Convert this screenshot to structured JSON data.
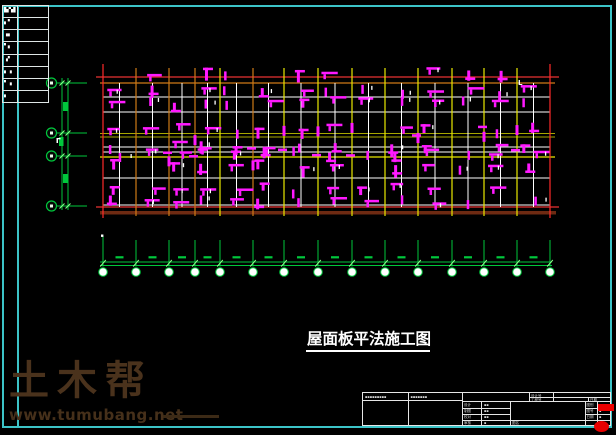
{
  "background": "#000000",
  "frame": {
    "color": "#3cc4c8",
    "table_rows": [
      "▙▚▌",
      "▖▘",
      "▗▖",
      "▘▖",
      "▗▘",
      "▖▗",
      "▘▗",
      "▖"
    ]
  },
  "drawing_title": {
    "text": "屋面板平法施工图"
  },
  "watermark": {
    "brand": "土木帮",
    "url": "www.tumubang.net",
    "color": "#4a321c"
  },
  "plan": {
    "beam_label": "L",
    "x_axes": [
      103,
      136,
      169,
      195,
      220,
      253,
      284,
      318,
      352,
      385,
      418,
      452,
      484,
      517,
      550
    ],
    "x_axis_colors": [
      "#ff2a2a",
      "#cf7a16",
      "#cf7a16",
      "#cf7a16",
      "#e8e800",
      "#cf7a16",
      "#e8e800",
      "#e8e800",
      "#e8e800",
      "#e8e800",
      "#e8e800",
      "#e8e800",
      "#e8e800",
      "#e8e800",
      "#ff2a2a"
    ],
    "h_lines": [
      {
        "y": 77,
        "x1": 96,
        "x2": 559,
        "c": "#e83232",
        "w": 1.2
      },
      {
        "y": 83,
        "x1": 100,
        "x2": 555,
        "c": "#cf7a16",
        "w": 1.2
      },
      {
        "y": 97,
        "x1": 103,
        "x2": 550,
        "c": "#ffffff",
        "w": 1
      },
      {
        "y": 112,
        "x1": 103,
        "x2": 550,
        "c": "#ffffff",
        "w": 1
      },
      {
        "y": 133.5,
        "x1": 100,
        "x2": 555,
        "c": "#a8a800",
        "w": 1
      },
      {
        "y": 137,
        "x1": 100,
        "x2": 555,
        "c": "#a8a800",
        "w": 1
      },
      {
        "y": 147,
        "x1": 103,
        "x2": 550,
        "c": "#ffffff",
        "w": 1
      },
      {
        "y": 152,
        "x1": 103,
        "x2": 550,
        "c": "#ffffff",
        "w": 1
      },
      {
        "y": 157,
        "x1": 100,
        "x2": 555,
        "c": "#e8e800",
        "w": 1.2
      },
      {
        "y": 178,
        "x1": 103,
        "x2": 550,
        "c": "#ffffff",
        "w": 1
      },
      {
        "y": 205,
        "x1": 103,
        "x2": 550,
        "c": "#ffffff",
        "w": 1
      },
      {
        "y": 207,
        "x1": 96,
        "x2": 559,
        "c": "#e83232",
        "w": 1.2
      }
    ],
    "base": {
      "x": 100,
      "y": 211,
      "w": 456,
      "h": 3.5,
      "color": "#6e2a12"
    },
    "rebar": {
      "color": "#ff19ff",
      "seed": 7,
      "bands": [
        [
          70,
          0.5
        ],
        [
          88,
          0.85
        ],
        [
          100,
          0.8
        ],
        [
          126,
          0.9
        ],
        [
          143,
          0.7
        ],
        [
          150,
          0.9
        ],
        [
          163,
          0.85
        ],
        [
          186,
          0.8
        ],
        [
          199,
          0.85
        ]
      ]
    }
  },
  "dims": {
    "color": "#00c83c",
    "left": {
      "circle_x": 51.5,
      "r": 5,
      "ys": [
        83,
        133,
        156,
        206
      ],
      "chain_x": [
        62,
        68
      ],
      "text_blocks": [
        [
          63,
          102
        ],
        [
          59,
          137
        ],
        [
          63,
          174
        ]
      ]
    },
    "bottom": {
      "y1": 262,
      "y2": 265.5,
      "x1": 100,
      "x2": 552,
      "tick_top": 240,
      "circle_y": 272,
      "r": 4.3,
      "text_y": 256.2
    }
  },
  "titleblock": {
    "header_a": "▪▪▪▪▪▪▪▪▪",
    "header_b": "▪▪▪▪▪▪▪",
    "design_no_label": "设计号",
    "proj_no_label": "工程号",
    "date_label": "日期",
    "sign_rows": [
      {
        "label": "设计",
        "value": "▪▪"
      },
      {
        "label": "制图",
        "value": "▪▪"
      },
      {
        "label": "校对",
        "value": "▪▪"
      },
      {
        "label": "审核",
        "value": "▪"
      }
    ],
    "name_label": "图名",
    "right_rows": [
      {
        "label": "图别",
        "value": "▪"
      },
      {
        "label": "图号",
        "value": "▪"
      },
      {
        "label": "日期",
        "value": "▪"
      }
    ]
  }
}
